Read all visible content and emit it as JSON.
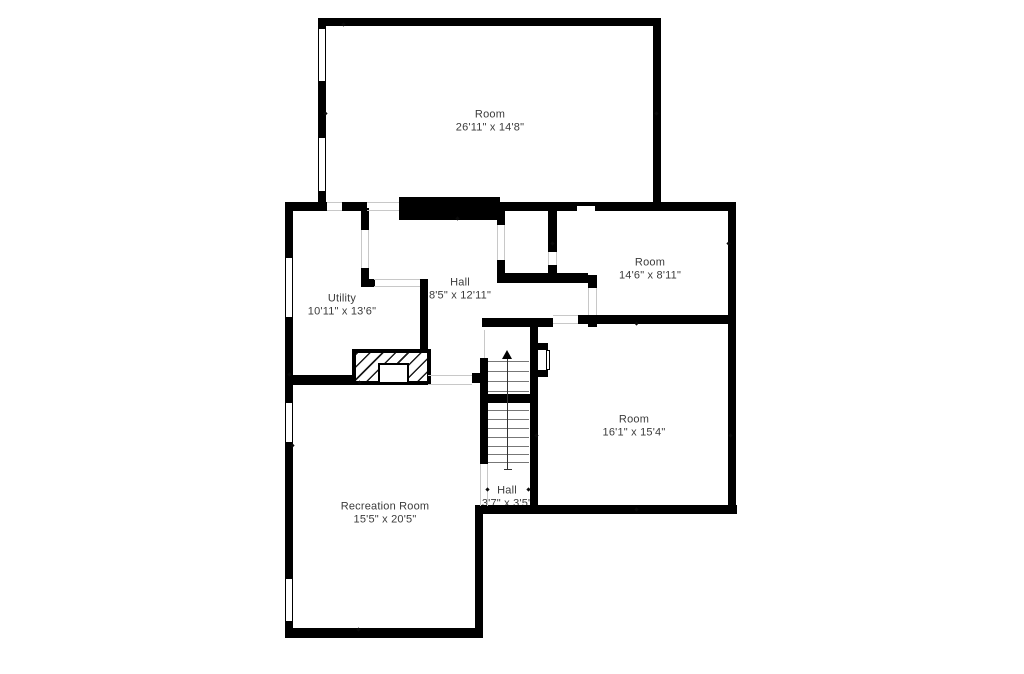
{
  "floorplan": {
    "rooms": [
      {
        "name": "Room",
        "dimensions": "26'11\" x 14'8\""
      },
      {
        "name": "Utility",
        "dimensions": "10'11\" x 13'6\""
      },
      {
        "name": "Hall",
        "dimensions": "8'5\" x 12'11\""
      },
      {
        "name": "Room",
        "dimensions": "14'6\" x 8'11\""
      },
      {
        "name": "Room",
        "dimensions": "16'1\" x 15'4\""
      },
      {
        "name": "Hall",
        "dimensions": "3'7\" x 3'5\""
      },
      {
        "name": "Recreation Room",
        "dimensions": "15'5\" x 20'5\""
      }
    ],
    "colors": {
      "wall": "#000000",
      "background": "#ffffff",
      "label_text": "#3b3b3b"
    },
    "icons": {
      "stairs_direction": "up-arrow"
    }
  }
}
